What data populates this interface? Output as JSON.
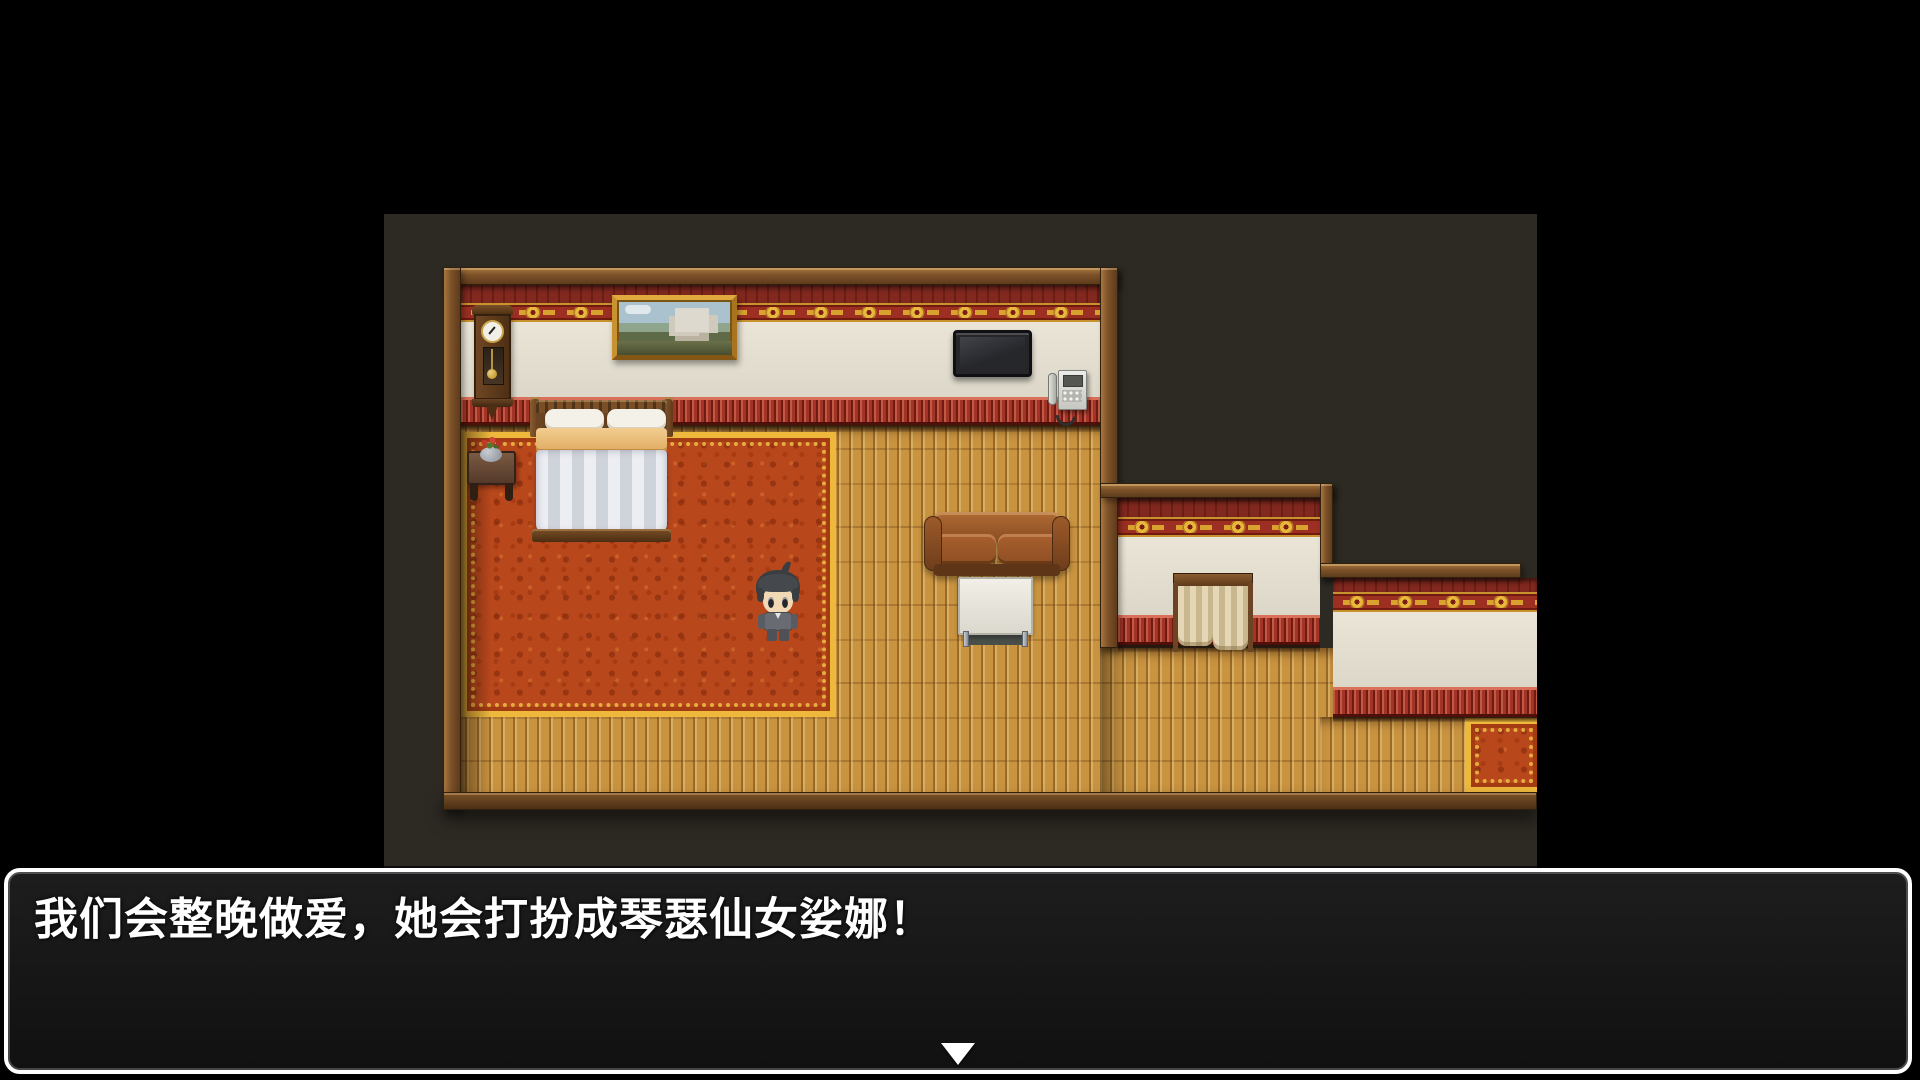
{
  "game": {
    "dialogue": {
      "text": "我们会整晚做爱，她会打扮成琴瑟仙女娑娜！",
      "continue_icon": "down-triangle"
    },
    "scene": {
      "objects": [
        "wall-clock",
        "landscape-painting",
        "double-bed",
        "nightstand-with-flowers",
        "flat-tv",
        "wall-phone",
        "leather-sofa",
        "white-table",
        "curtained-doorway",
        "red-carpet",
        "small-red-carpet",
        "player-character"
      ]
    },
    "colors": {
      "viewport_bg": "#2d2923",
      "wood_frame": "#7c5128",
      "wall_cream": "#e7e2d4",
      "wall_red_band": "#7e2820",
      "frieze_red": "#9c2f22",
      "frieze_gold": "#e9b73b",
      "wainscot_red": "#a23327",
      "floor_wood": "#c99440",
      "carpet_orange": "#b8471c",
      "carpet_gold": "#edb83c",
      "dialogue_bg": "#191919",
      "dialogue_border": "#ffffff",
      "dialogue_text": "#ffffff"
    }
  }
}
